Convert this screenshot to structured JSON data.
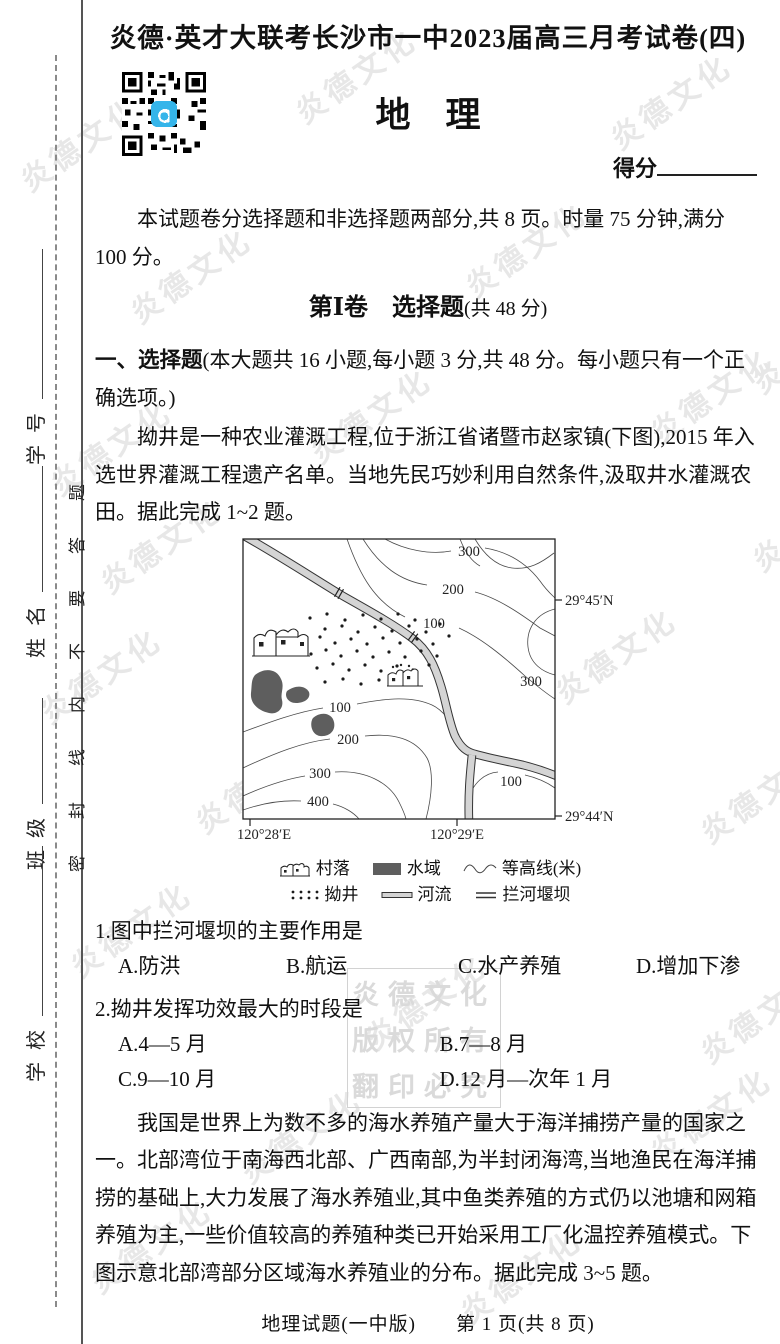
{
  "page": {
    "header_title": "炎德·英才大联考长沙市一中2023届高三月考试卷(四)",
    "subject_title": "地　理",
    "score_label": "得分",
    "intro": "本试题卷分选择题和非选择题两部分,共 8 页。时量 75 分钟,满分 100 分。",
    "footer": "地理试题(一中版)　　第 1 页(共 8 页)"
  },
  "sidebar": {
    "seal_text": "密封线内不要答题",
    "fields": [
      {
        "label": "学校"
      },
      {
        "label": "班级"
      },
      {
        "label": "姓名"
      },
      {
        "label": "学号"
      }
    ]
  },
  "watermark": {
    "text": "炎德文化",
    "box_lines": [
      "炎德文化",
      "版权所有",
      "翻印必究"
    ]
  },
  "section1": {
    "volume_heading_main": "第Ⅰ卷　选择题",
    "volume_heading_sub": "(共 48 分)",
    "instruction_lead": "一、选择题",
    "instruction_body": "(本大题共 16 小题,每小题 3 分,共 48 分。每小题只有一个正确选项。)"
  },
  "passage1": "拗井是一种农业灌溉工程,位于浙江省诸暨市赵家镇(下图),2015 年入选世界灌溉工程遗产名单。当地先民巧妙利用自然条件,汲取井水灌溉农田。据此完成 1~2 题。",
  "map": {
    "contour_labels": [
      "300",
      "200",
      "100",
      "300",
      "100",
      "200",
      "300",
      "400",
      "100"
    ],
    "lat_top": "29°45′N",
    "lat_bottom": "29°44′N",
    "lon_left": "120°28′E",
    "lon_right": "120°29′E",
    "legend": {
      "village": "村落",
      "water": "水域",
      "contour": "等高线(米)",
      "well": "拗井",
      "river": "河流",
      "dam": "拦河堰坝"
    }
  },
  "questions": [
    {
      "num": "1.",
      "stem": "图中拦河堰坝的主要作用是",
      "options": [
        "A.防洪",
        "B.航运",
        "C.水产养殖",
        "D.增加下渗"
      ]
    },
    {
      "num": "2.",
      "stem": "拗井发挥功效最大的时段是",
      "options": [
        "A.4—5 月",
        "B.7—8 月",
        "C.9—10 月",
        "D.12 月—次年 1 月"
      ]
    }
  ],
  "passage2": "我国是世界上为数不多的海水养殖产量大于海洋捕捞产量的国家之一。北部湾位于南海西北部、广西南部,为半封闭海湾,当地渔民在海洋捕捞的基础上,大力发展了海水养殖业,其中鱼类养殖的方式仍以池塘和网箱养殖为主,一些价值较高的养殖种类已开始采用工厂化温控养殖模式。下图示意北部湾部分区域海水养殖业的分布。据此完成 3~5 题。"
}
